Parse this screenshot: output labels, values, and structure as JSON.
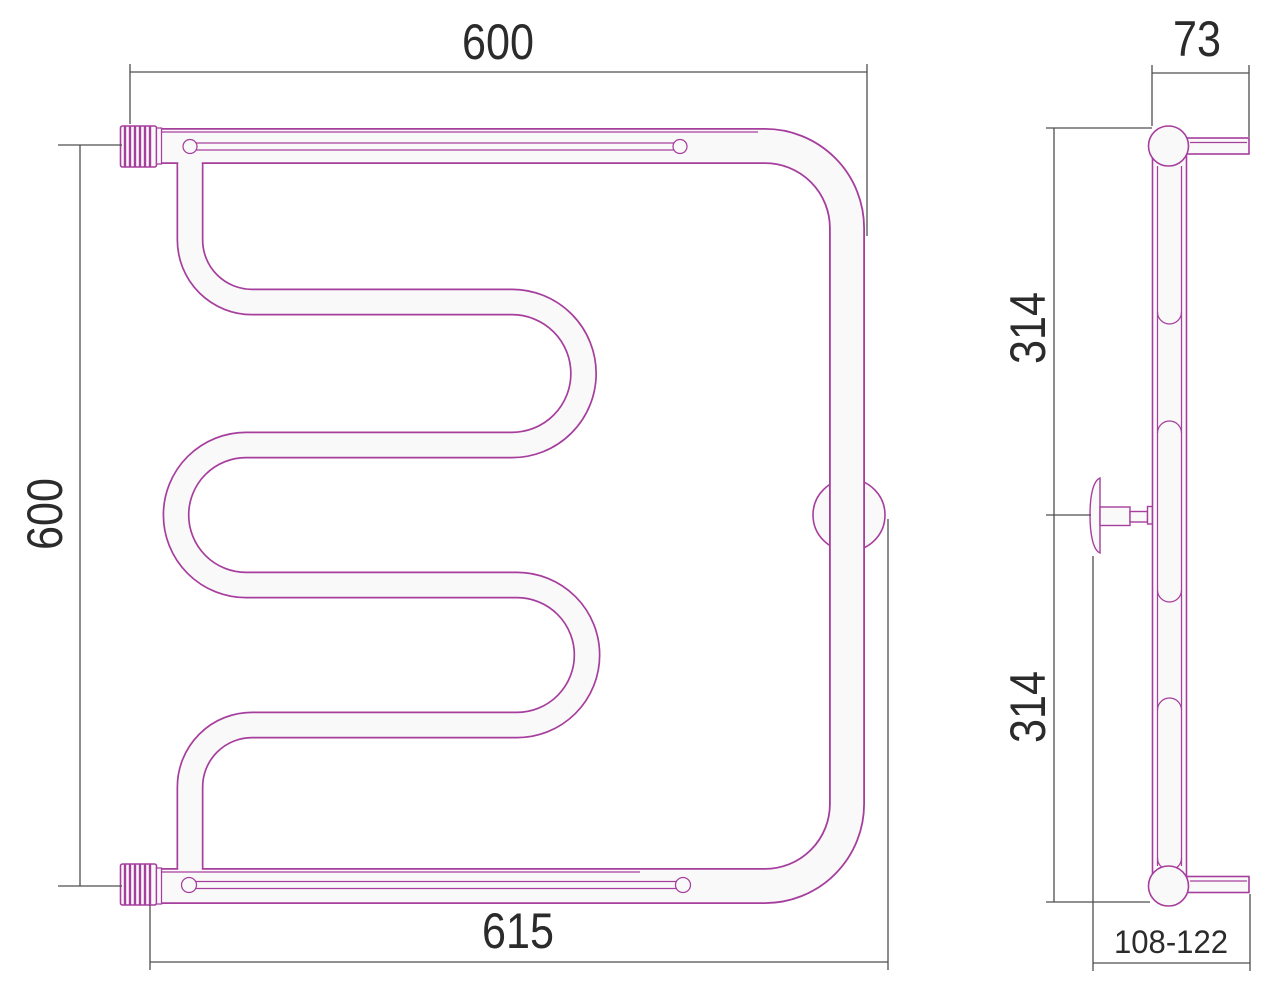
{
  "meta": {
    "type": "technical-drawing",
    "subject": "towel-rail-two-views"
  },
  "front_view": {
    "dim_top_width": "600",
    "dim_left_height": "600",
    "dim_bottom_width": "615"
  },
  "side_view": {
    "dim_depth": "73",
    "dim_upper_span": "314",
    "dim_lower_span": "314",
    "dim_wall_offset_range": "108-122"
  },
  "colors": {
    "pipe_stroke": "#a63e9d",
    "pipe_fill": "#faf9fa",
    "dimension_line": "#4f4f4f",
    "text": "#2b2b2b",
    "background": "#ffffff"
  }
}
